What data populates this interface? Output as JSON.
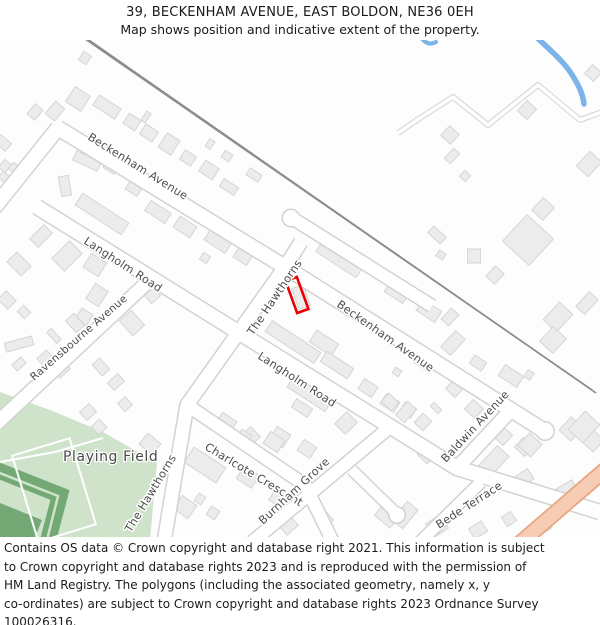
{
  "header": {
    "title": "39, BECKENHAM AVENUE, EAST BOLDON, NE36 0EH",
    "subtitle": "Map shows position and indicative extent of the property."
  },
  "map": {
    "labels": {
      "beckenham_1": "Beckenham Avenue",
      "beckenham_2": "Beckenham Avenue",
      "langholm_1": "Langholm Road",
      "langholm_2": "Langholm Road",
      "ravensbourne": "Ravensbourne Avenue",
      "hawthorns_1": "The Hawthorns",
      "hawthorns_2": "The Hawthorns",
      "charlcote": "Charlcote Crescent",
      "burnham": "Burnham Grove",
      "baldwin": "Baldwin Avenue",
      "bede": "Bede Terrace",
      "playing_field": "Playing Field"
    }
  },
  "colors": {
    "property_outline": "#ee0000",
    "playing_field": "#cfe3ca",
    "trees": "#74a975",
    "water": "#7cb3e8",
    "primary_road_fill": "#f6cdb4",
    "primary_road_border": "#e8a580",
    "building_fill": "#ececec",
    "building_border": "#d5d5d5",
    "road_fill": "#ffffff",
    "road_border": "#d2d2d2"
  },
  "footer": {
    "lines": [
      "Contains OS data © Crown copyright and database right 2021. This information is subject",
      "to Crown copyright and database rights 2023 and is reproduced with the permission of",
      "HM Land Registry. The polygons (including the associated geometry, namely x, y",
      "co-ordinates) are subject to Crown copyright and database rights 2023 Ordnance Survey",
      "100026316."
    ]
  }
}
